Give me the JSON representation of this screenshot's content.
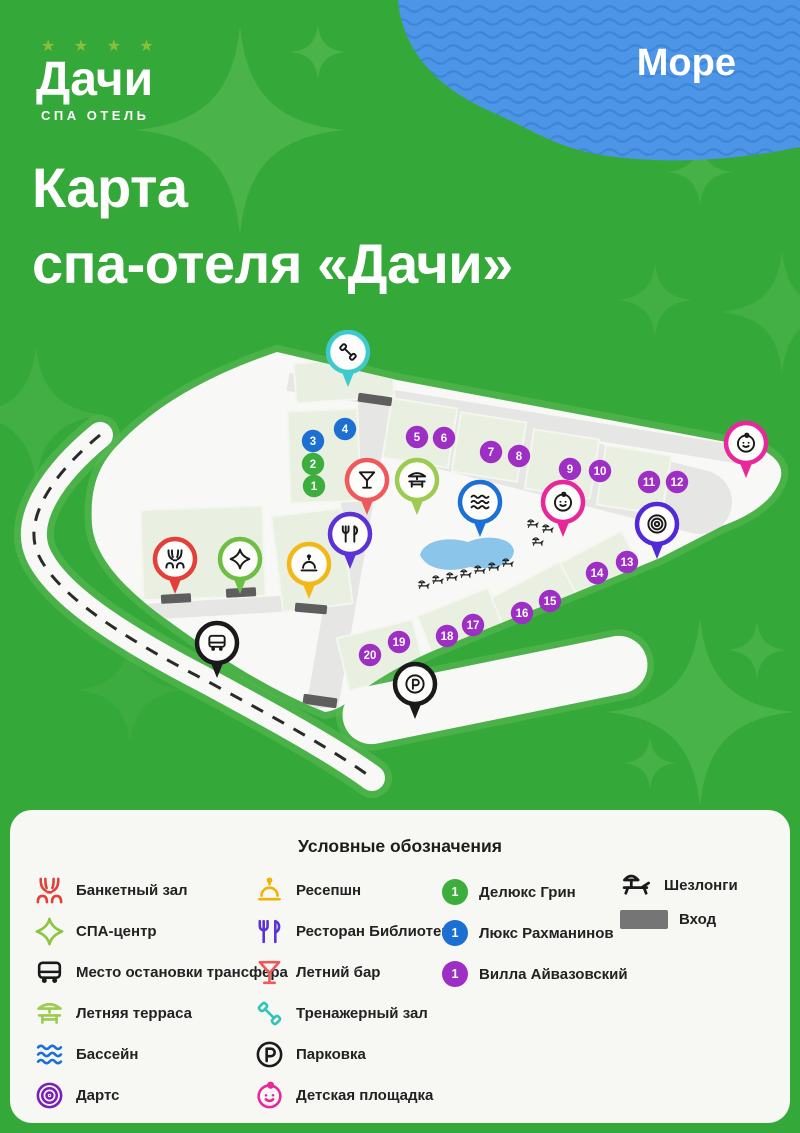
{
  "brand": {
    "stars": "★ ★ ★ ★",
    "name": "Дачи",
    "tagline": "СПА ОТЕЛЬ"
  },
  "title": {
    "line1": "Карта",
    "line2": "спа-отеля «Дачи»"
  },
  "sea": {
    "label": "Море"
  },
  "colors": {
    "background_green": "#35A83A",
    "sea_blue": "#4D95E6",
    "sea_wave": "#3E86D8",
    "map_white": "#F8F8F6",
    "path_gray": "#E6E6E4",
    "block_green": "#E9EFE1",
    "pool_blue": "#8BC5EA",
    "room_green": "#3CAE3E",
    "room_blue": "#1E6FD2",
    "room_purple": "#9D2FC4"
  },
  "map": {
    "pins": [
      {
        "icon": "gym",
        "color": "#3EC9CC",
        "x": 348,
        "y": 22
      },
      {
        "icon": "bar",
        "color": "#F0595C",
        "x": 367,
        "y": 150
      },
      {
        "icon": "terrace",
        "color": "#9CCB50",
        "x": 417,
        "y": 150
      },
      {
        "icon": "pool",
        "color": "#1B6FD6",
        "x": 480,
        "y": 172
      },
      {
        "icon": "restaurant",
        "color": "#5B32D6",
        "x": 350,
        "y": 204
      },
      {
        "icon": "bell",
        "color": "#F2B818",
        "x": 309,
        "y": 234
      },
      {
        "icon": "banquet",
        "color": "#E3403A",
        "x": 175,
        "y": 229
      },
      {
        "icon": "spa",
        "color": "#6FBE44",
        "x": 240,
        "y": 229
      },
      {
        "icon": "bus",
        "color": "#1A1A1A",
        "x": 217,
        "y": 313
      },
      {
        "icon": "kids",
        "color": "#E8289A",
        "x": 563,
        "y": 172
      },
      {
        "icon": "kids",
        "color": "#E8289A",
        "x": 746,
        "y": 113
      },
      {
        "icon": "darts",
        "color": "#5229D8",
        "x": 657,
        "y": 194
      },
      {
        "icon": "parking",
        "color": "#1A1A1A",
        "x": 415,
        "y": 354
      }
    ],
    "rooms": [
      {
        "n": "1",
        "color": "#3CAE3E",
        "x": 314,
        "y": 156
      },
      {
        "n": "2",
        "color": "#3CAE3E",
        "x": 313,
        "y": 134
      },
      {
        "n": "3",
        "color": "#1E6FD2",
        "x": 313,
        "y": 111
      },
      {
        "n": "4",
        "color": "#1E6FD2",
        "x": 345,
        "y": 99
      },
      {
        "n": "5",
        "color": "#9D2FC4",
        "x": 417,
        "y": 107
      },
      {
        "n": "6",
        "color": "#9D2FC4",
        "x": 444,
        "y": 108
      },
      {
        "n": "7",
        "color": "#9D2FC4",
        "x": 491,
        "y": 122
      },
      {
        "n": "8",
        "color": "#9D2FC4",
        "x": 519,
        "y": 126
      },
      {
        "n": "9",
        "color": "#9D2FC4",
        "x": 570,
        "y": 139
      },
      {
        "n": "10",
        "color": "#9D2FC4",
        "x": 600,
        "y": 141
      },
      {
        "n": "11",
        "color": "#9D2FC4",
        "x": 649,
        "y": 152
      },
      {
        "n": "12",
        "color": "#9D2FC4",
        "x": 677,
        "y": 152
      },
      {
        "n": "13",
        "color": "#9D2FC4",
        "x": 627,
        "y": 232
      },
      {
        "n": "14",
        "color": "#9D2FC4",
        "x": 597,
        "y": 243
      },
      {
        "n": "15",
        "color": "#9D2FC4",
        "x": 550,
        "y": 271
      },
      {
        "n": "16",
        "color": "#9D2FC4",
        "x": 522,
        "y": 283
      },
      {
        "n": "17",
        "color": "#9D2FC4",
        "x": 473,
        "y": 295
      },
      {
        "n": "18",
        "color": "#9D2FC4",
        "x": 447,
        "y": 306
      },
      {
        "n": "19",
        "color": "#9D2FC4",
        "x": 399,
        "y": 312
      },
      {
        "n": "20",
        "color": "#9D2FC4",
        "x": 370,
        "y": 325
      }
    ]
  },
  "legend": {
    "title": "Условные обозначения",
    "columns": [
      {
        "items": [
          {
            "icon": "banquet",
            "color": "#E3403A",
            "label": "Банкетный зал"
          },
          {
            "icon": "spa",
            "color": "#8CC63E",
            "label": "СПА-центр"
          },
          {
            "icon": "bus",
            "color": "#1A1A1A",
            "label": "Место остановки трансфера"
          },
          {
            "icon": "terrace",
            "color": "#9CCB50",
            "label": "Летняя терраса"
          },
          {
            "icon": "pool",
            "color": "#1B6FD6",
            "label": "Бассейн"
          },
          {
            "icon": "darts",
            "color": "#7A1FB8",
            "label": "Дартс"
          }
        ]
      },
      {
        "items": [
          {
            "icon": "bell",
            "color": "#F0B400",
            "label": "Ресепшн"
          },
          {
            "icon": "restaurant",
            "color": "#5B32D6",
            "label": "Ресторан Библиотека"
          },
          {
            "icon": "bar",
            "color": "#F0595C",
            "label": "Летний бар"
          },
          {
            "icon": "gym",
            "color": "#2EC4B8",
            "label": "Тренажерный зал"
          },
          {
            "icon": "parking",
            "color": "#1A1A1A",
            "label": "Парковка"
          },
          {
            "icon": "kids",
            "color": "#E8289A",
            "label": "Детская площадка"
          }
        ]
      },
      {
        "items": [
          {
            "badge": "1",
            "color": "#3CAE3E",
            "label": "Делюкс Грин"
          },
          {
            "badge": "1",
            "color": "#1B6ED2",
            "label": "Люкс Рахманинов"
          },
          {
            "badge": "1",
            "color": "#9D2FC4",
            "label": "Вилла Айвазовский"
          }
        ]
      },
      {
        "items": [
          {
            "icon": "lounger",
            "color": "#1A1A1A",
            "label": "Шезлонги"
          },
          {
            "icon": "entrance",
            "color": "#757575",
            "label": "Вход"
          }
        ]
      }
    ]
  }
}
